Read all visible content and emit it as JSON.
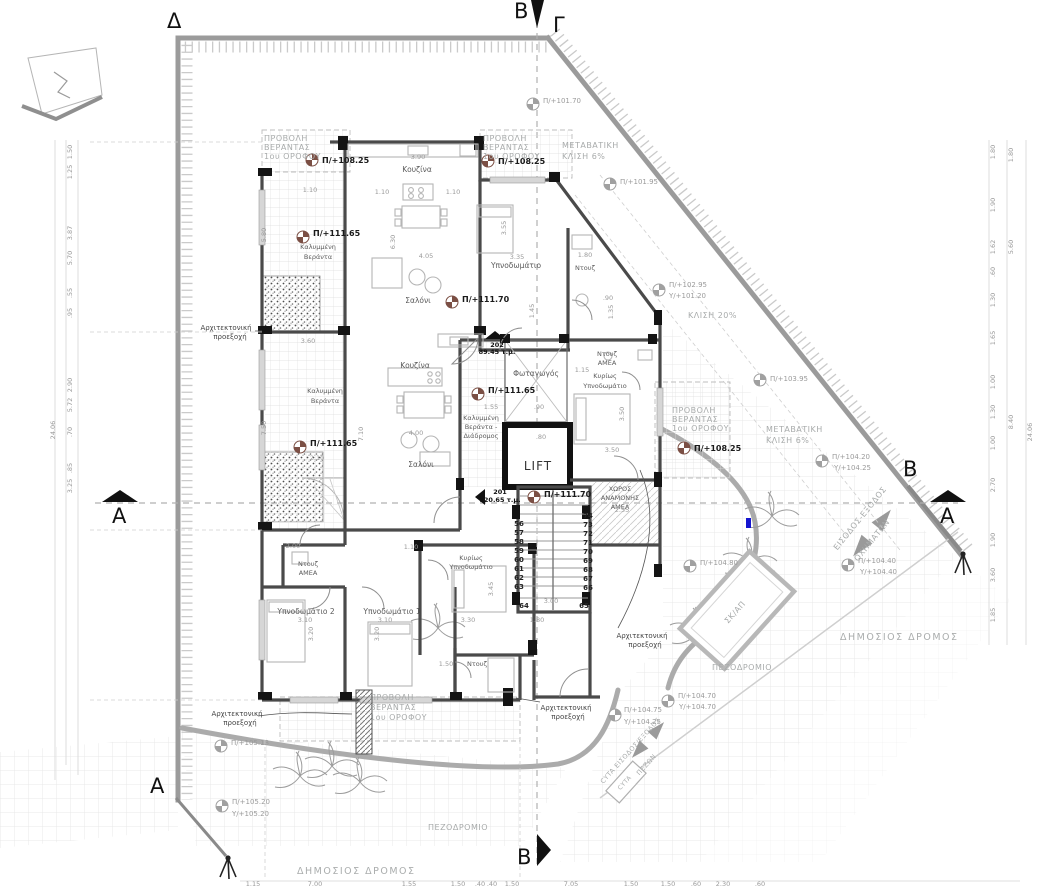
{
  "sections": {
    "d": "Δ",
    "g": "Γ",
    "b": "Β",
    "a": "Α"
  },
  "site": {
    "public_road": "ΔΗΜΟΣΙΟΣ ΔΡΟΜΟΣ",
    "sidewalk": "ΠΕΖΟΔΡΟΜΙΟ",
    "bins": "ΣΚ/ΑΠ",
    "vehicle_access_1": "ΕΙΣΟΔΟΣ-ΕΞΟΔΟΣ",
    "vehicle_access_2": "ΟΧΗΜΑΤΩΝ",
    "cyta_access_1": "CYTA ΕΙΣΟΔΟΣ/ΕΞΟΔΟΣ",
    "cyta_access_2": "ΠΕΖΩΝ",
    "cyta": "CYTA",
    "trans_slope_1": "ΜΕΤΑΒΑΤΙΚΗ",
    "trans_slope_2": "ΚΛΙΣΗ 6%",
    "slope_20": "ΚΛΙΣΗ 20%"
  },
  "projection": {
    "l1": "ΠΡΟΒΟΛΗ",
    "l2": "ΒΕΡΑΝΤΑΣ",
    "l3": "1ου ΟΡΟΦΟΥ"
  },
  "annotation": {
    "arch_1": "Αρχιτεκτονική",
    "arch_2": "προεξοχή"
  },
  "rooms": {
    "kitchen": "Κουζίνα",
    "living": "Σαλόνι",
    "bedroom": "Υπνοδωμάτιο",
    "bedroom1": "Υπνοδωμάτιο 1",
    "bedroom2": "Υπνοδωμάτιο 2",
    "master_1": "Κυρίως",
    "master_2": "Υπνοδωμάτιο",
    "shower": "Ντουζ",
    "amea": "ΑΜΕΑ",
    "lightwell": "Φωταγωγός",
    "lift": "LIFT",
    "cov_veranda_1": "Καλυμμένη",
    "cov_veranda_2": "Βεράντα",
    "corr_veranda_2": "Βεράντα -",
    "corr_veranda_3": "Διάδρομος",
    "waiting_1": "ΧΩΡΟΣ",
    "waiting_2": "ΑΝΑΜΟΝΗΣ",
    "waiting_3": "ΑΜΕΑ"
  },
  "apartments": {
    "a201": {
      "no": "201",
      "area": "120.65 τ.μ."
    },
    "a202": {
      "no": "202",
      "area": "89.45 τ.μ."
    }
  },
  "levels": {
    "p101_70": "Π/+101.70",
    "p101_95": "Π/+101.95",
    "p102_95": "Π/+102.95",
    "y101_20": "Υ/+101.20",
    "p103_95": "Π/+103.95",
    "p104_20": "Π/+104.20",
    "y104_25": "Υ/+104.25",
    "p104_40": "Π/+104.40",
    "y104_40": "Υ/+104.40",
    "p104_70": "Π/+104.70",
    "y104_70": "Υ/+104.70",
    "p104_75": "Π/+104.75",
    "p104_80": "Π/+104.80",
    "p105_18": "Π/+105.18",
    "p105_20": "Π/+105.20",
    "y105_20": "Υ/+105.20",
    "p108_25": "Π/+108.25",
    "p111_65": "Π/+111.65",
    "p111_70": "Π/+111.70"
  },
  "stairs": {
    "left": [
      "56",
      "57",
      "58",
      "59",
      "60",
      "61",
      "62",
      "63"
    ],
    "left_last": "64",
    "right": [
      "74",
      "73",
      "72",
      "71",
      "70",
      "69",
      "68",
      "67",
      "66"
    ],
    "right_last": "65"
  },
  "dims": {
    "inner": [
      "3.90",
      "1.10",
      "1.10",
      "1.10",
      "6.30",
      "4.05",
      "3.35",
      "3.55",
      "1.80",
      "3.60",
      "7.50",
      "2.10",
      "7.10",
      "4.00",
      "1.55",
      ".90",
      "3.50",
      "3.50",
      "1.15",
      "2.55",
      "3.00",
      "3.45",
      "3.30",
      "3.10",
      "3.20",
      "3.10",
      "3.20",
      "1.50",
      "2.00",
      "1.10",
      "1.80",
      "5.80",
      ".90",
      "1.35",
      "1.45",
      ".80"
    ],
    "left": [
      "1.50",
      "1.25",
      "3.87",
      "5.70",
      ".55",
      ".95",
      "2.90",
      "5.72",
      ".70",
      ".85",
      "3.25"
    ],
    "left_total": "24.06",
    "right1": [
      "1.80",
      "1.90",
      "1.62",
      ".60",
      "1.30",
      "1.65",
      "1.00",
      "1.30",
      "1.00",
      "2.70",
      "1.90",
      "3.60",
      "1.85"
    ],
    "right2": [
      "1.80",
      "5.60",
      "8.40"
    ],
    "right_total": "24.06",
    "bottom": [
      "1.15",
      "7.00",
      "1.55",
      "1.50",
      ".40",
      ".40",
      "1.50",
      "7.05",
      "1.50",
      "1.50",
      ".60",
      "2.30",
      ".60"
    ]
  }
}
